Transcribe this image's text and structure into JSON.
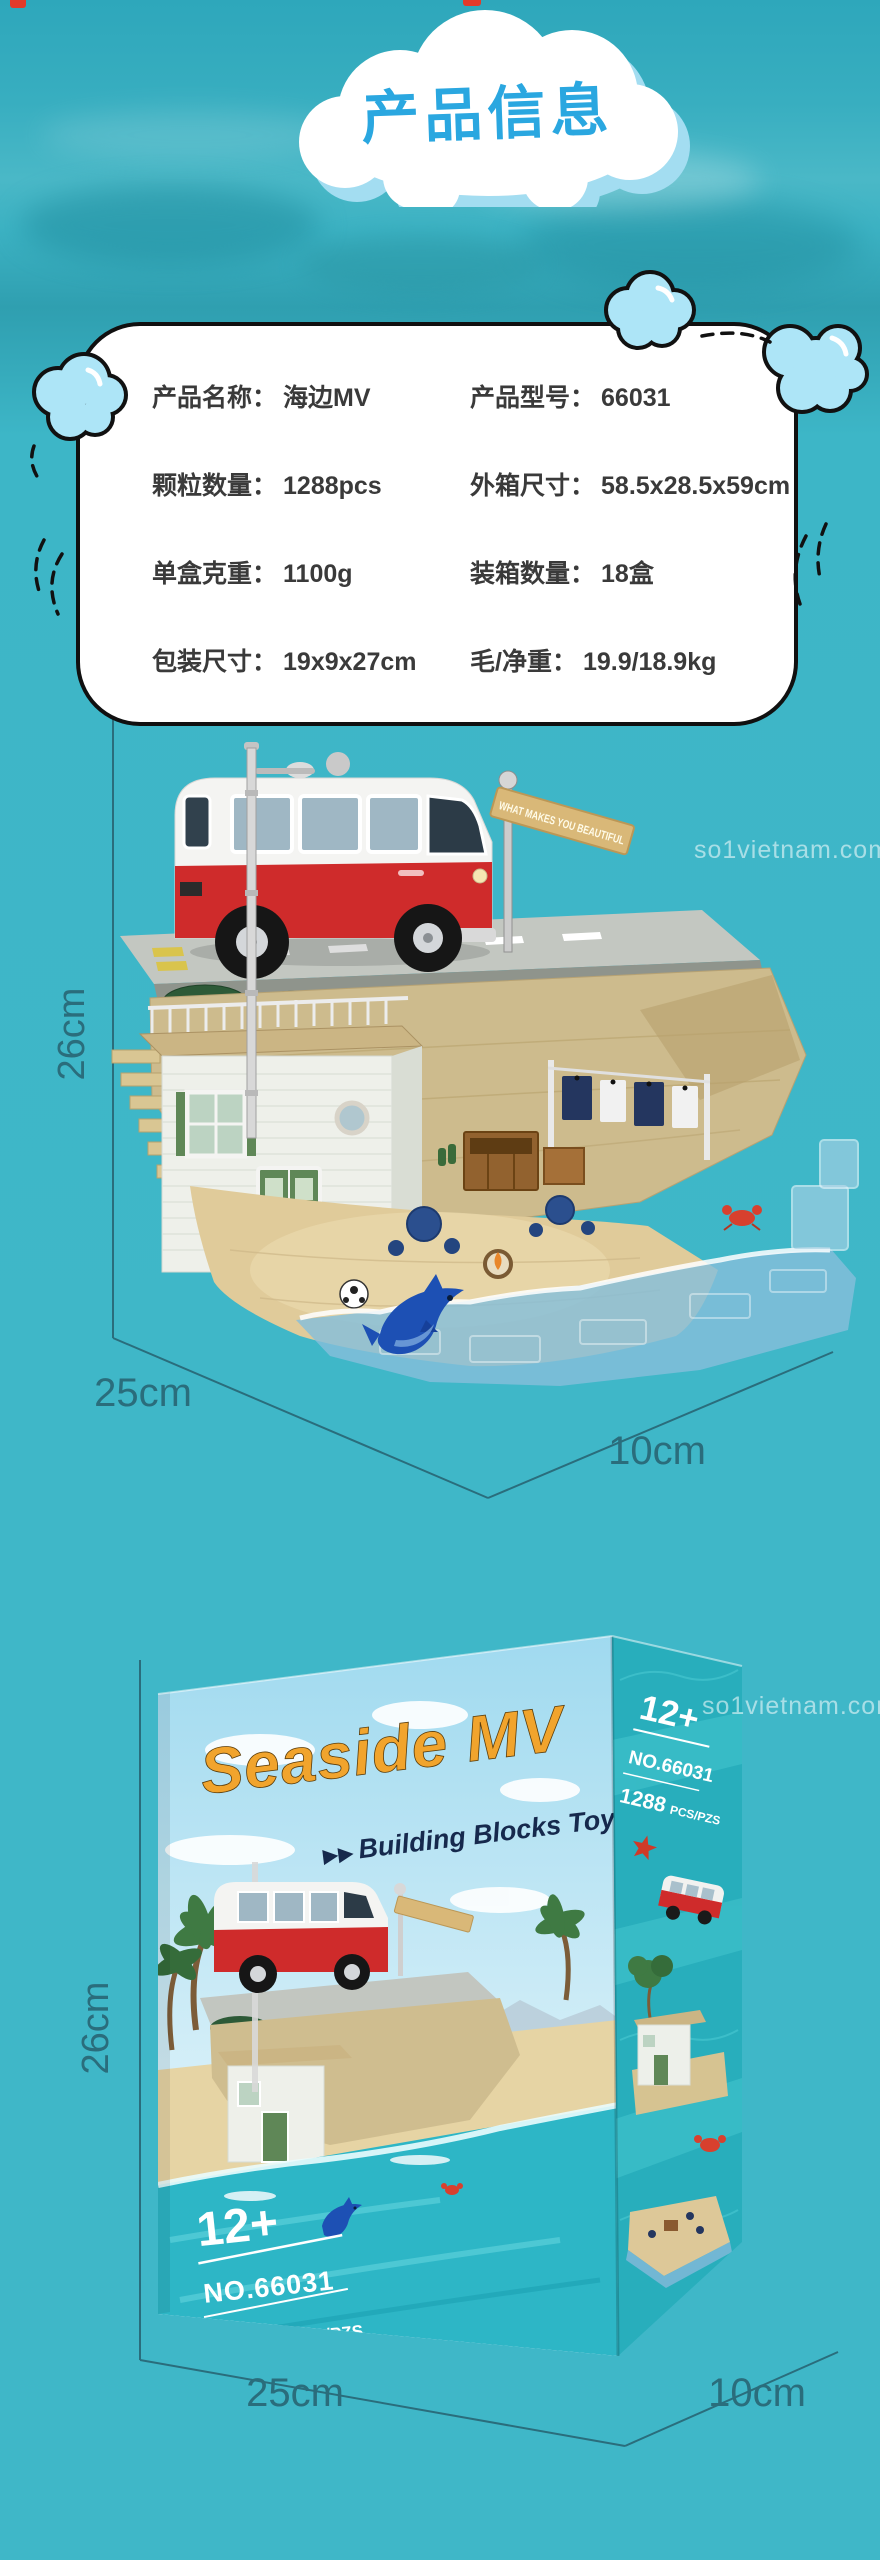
{
  "theme": {
    "teal_background": "#3fb7c8",
    "title_blue": "#2aa7e0",
    "dimension_color": "#2a6d7c",
    "deco_cloud_fill": "#ade5f7",
    "card_border": "#101010",
    "card_text": "#3a3a3a",
    "van_red": "#cf2b2b",
    "logo_orange": "#f1a42d",
    "tagline_navy": "#16294d",
    "box_side_teal": "#28aebc",
    "starfish_red": "#cf3a28",
    "watermark_color": "rgba(255,255,255,0.55)"
  },
  "header": {
    "title": "产品信息"
  },
  "info_card": {
    "rows": [
      {
        "left_label": "产品名称：",
        "left_value": "海边MV",
        "right_label": "产品型号：",
        "right_value": "66031"
      },
      {
        "left_label": "颗粒数量：",
        "left_value": "1288pcs",
        "right_label": "外箱尺寸：",
        "right_value": "58.5x28.5x59cm"
      },
      {
        "left_label": "单盒克重：",
        "left_value": "1100g",
        "right_label": "装箱数量：",
        "right_value": "18盒"
      },
      {
        "left_label": "包装尺寸：",
        "left_value": "19x9x27cm",
        "right_label": "毛/净重：",
        "right_value": "19.9/18.9kg"
      }
    ]
  },
  "model_photo": {
    "height_label": "26cm",
    "width_label": "25cm",
    "depth_label": "10cm",
    "sign_text": "WHAT MAKES YOU BEAUTIFUL",
    "watermark": "so1vietnam.com"
  },
  "box_photo": {
    "height_label": "26cm",
    "width_label": "25cm",
    "depth_label": "10cm",
    "watermark": "so1vietnam.com",
    "front": {
      "logo": "Seaside MV",
      "tagline_marker": "▶▶",
      "tagline": "Building Blocks Toy",
      "age": "12+",
      "model_no": "NO.66031",
      "pieces": "1288",
      "pieces_unit": "PCS/PZS"
    },
    "side": {
      "age": "12+",
      "model_no": "NO.66031",
      "pieces": "1288",
      "pieces_unit": "PCS/PZS"
    }
  }
}
